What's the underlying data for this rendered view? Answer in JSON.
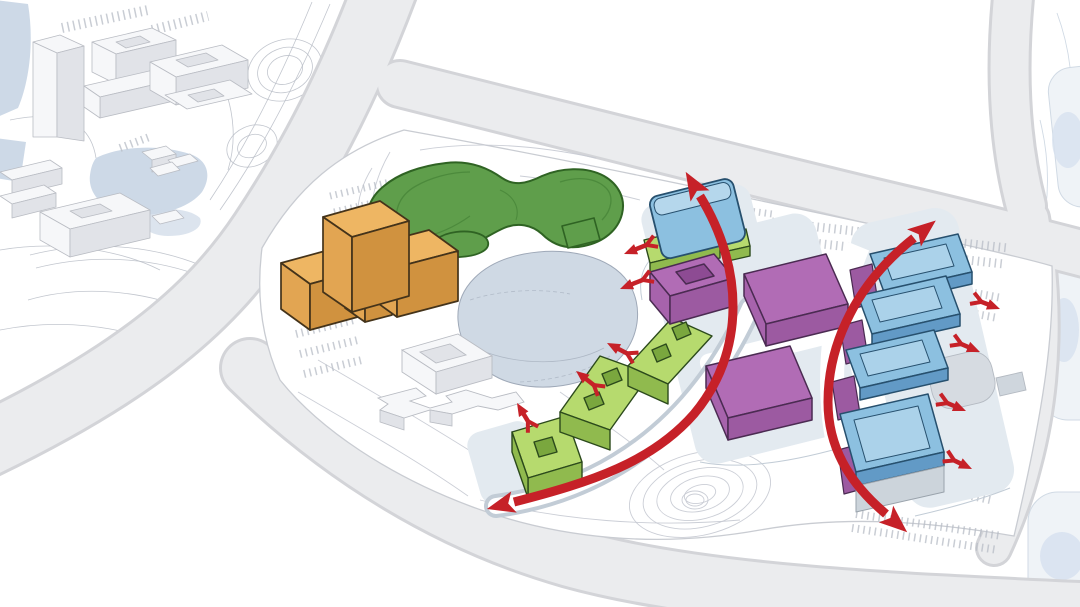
{
  "diagram": {
    "kind": "architectural-masterplan-circulation-diagram",
    "visible_text": [],
    "element_inventory": {
      "context_district_buildings": 9,
      "orange_blocks": 4,
      "green_hill_blobs": 2,
      "pond": 1,
      "white_courtyard_building": 1,
      "lime_bar_buildings": 5,
      "purple_halls": 3,
      "blue_gable_building": 1,
      "blue_slab_buildings": 4,
      "purple_bases": 4,
      "round_pavilion": 1,
      "big_flow_arrows": 2,
      "small_flow_arrows": 9
    }
  },
  "colors": {
    "bg": "#ffffff",
    "road_fill": "#ebecee",
    "road_edge": "#d3d4d8",
    "context_line": "#b7bcc6",
    "context_building_top": "#f6f7f9",
    "context_building_side": "#e1e3e8",
    "context_building_edge": "#b9bcc3",
    "water": "#cdd9e7",
    "site_line": "#c5c9d1",
    "site_edge": "#c9ccd2",
    "green_fill": "#5f9e4b",
    "green_dark": "#4c8a3c",
    "green_outline": "#2f6323",
    "pond_fill": "#cfd9e4",
    "pond_edge": "#9fa9b8",
    "orange_top": "#eeb663",
    "orange_left": "#e2a552",
    "orange_right": "#d0923f",
    "orange_outline": "#44331a",
    "lime_top": "#b6da6e",
    "lime_side": "#90ba4e",
    "lime_slot": "#7aa73e",
    "lime_outline": "#2c4a1c",
    "purple_top": "#b16cb5",
    "purple_left": "#a763ac",
    "purple_front": "#9c5aa1",
    "purple_dark": "#8d4b93",
    "purple_outline": "#4b2b52",
    "blue_top": "#b5d7ec",
    "blue_face": "#8cc0e0",
    "blue_side": "#629ac6",
    "blue_inset": "#abd2ea",
    "blue_outline": "#27506e",
    "podium_fill": "#e3eaf0",
    "podium_edge": "#c2ccd6",
    "pavilion_fill": "#d6dbe1",
    "pavilion_edge": "#b4bac2",
    "arrow_red": "#c62128",
    "right_context_fill": "#eef2f7",
    "right_context_edge": "#ccd6e2",
    "right_context_water": "#d3dfee"
  },
  "arrows": {
    "big": [
      {
        "id": "flow-arrow-west",
        "path": "M 700,196 C 744,268 746,352 694,414 C 652,462 592,482 514,502",
        "heads": "both"
      },
      {
        "id": "flow-arrow-east",
        "path": "M 914,238 C 858,282 828,342 828,402 C 828,446 848,482 886,514",
        "heads": "both"
      }
    ],
    "small": [
      {
        "x1": 654,
        "y1": 242,
        "x2": 624,
        "y2": 254
      },
      {
        "x1": 650,
        "y1": 277,
        "x2": 620,
        "y2": 289
      },
      {
        "x1": 634,
        "y1": 357,
        "x2": 607,
        "y2": 343
      },
      {
        "x1": 600,
        "y1": 390,
        "x2": 576,
        "y2": 371
      },
      {
        "x1": 532,
        "y1": 428,
        "x2": 517,
        "y2": 403
      },
      {
        "x1": 974,
        "y1": 299,
        "x2": 1000,
        "y2": 309
      },
      {
        "x1": 954,
        "y1": 341,
        "x2": 980,
        "y2": 352
      },
      {
        "x1": 940,
        "y1": 400,
        "x2": 966,
        "y2": 411
      },
      {
        "x1": 947,
        "y1": 457,
        "x2": 972,
        "y2": 469
      }
    ]
  }
}
